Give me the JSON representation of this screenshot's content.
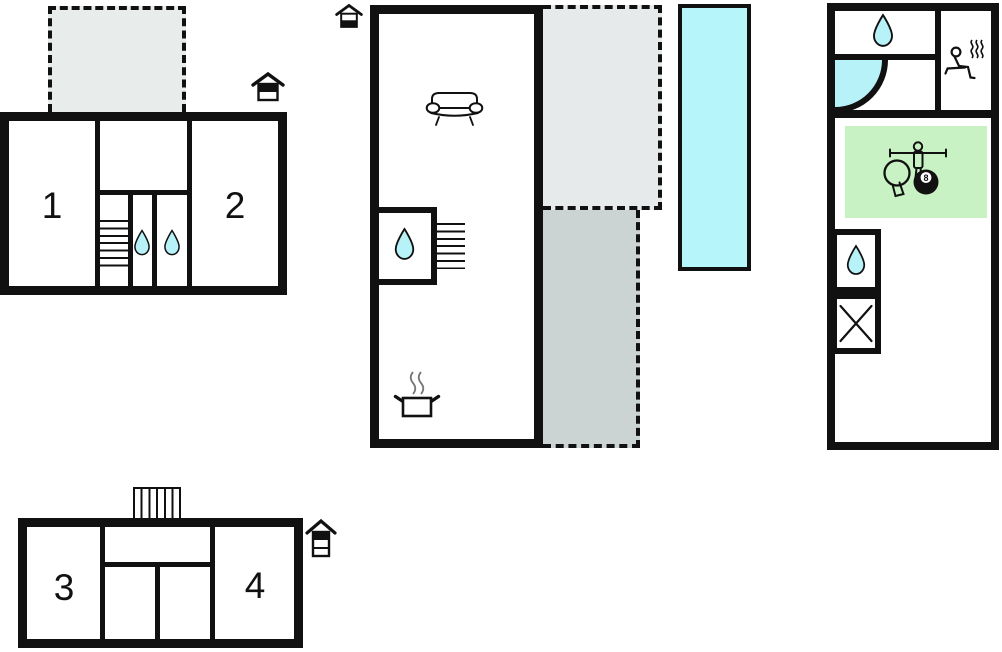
{
  "page": {
    "type": "vacation-home-floor-plan"
  },
  "colors": {
    "background": "#ffffff",
    "wall": "#111111",
    "water": "#b6f2f7",
    "pool": "#b6f6fa",
    "terrace_upper": "#e8edeb",
    "terrace_light": "#e7eaea",
    "terrace_dark": "#cbd3d3",
    "green": "#c9f2c4"
  },
  "labels": {
    "room1": "1",
    "room2": "2",
    "room3": "3",
    "room4": "4",
    "eight_ball": "8"
  },
  "buildings": {
    "upper_left": {
      "rooms": [
        "1",
        "2"
      ],
      "features": [
        "dashed-terrace",
        "stairs",
        "water-drop",
        "water-drop"
      ],
      "floor_icon": "house-upper-floor-marked"
    },
    "middle": {
      "features": [
        "sofa",
        "water-drop",
        "stairs",
        "cooking-pot",
        "dashed-terrace-light",
        "dashed-terrace-dark"
      ],
      "floor_icon": "house-ground-floor-marked"
    },
    "pool": {
      "feature": "swimming-pool"
    },
    "right": {
      "features": [
        "water-drop",
        "corner-bathtub",
        "sauna",
        "games-room-table-tennis-foosball-billiards",
        "water-drop",
        "crossed-out-room"
      ]
    },
    "lower_left": {
      "rooms": [
        "3",
        "4"
      ],
      "features": [
        "stairs"
      ],
      "floor_icon": "house-three-level-top-marked"
    }
  }
}
